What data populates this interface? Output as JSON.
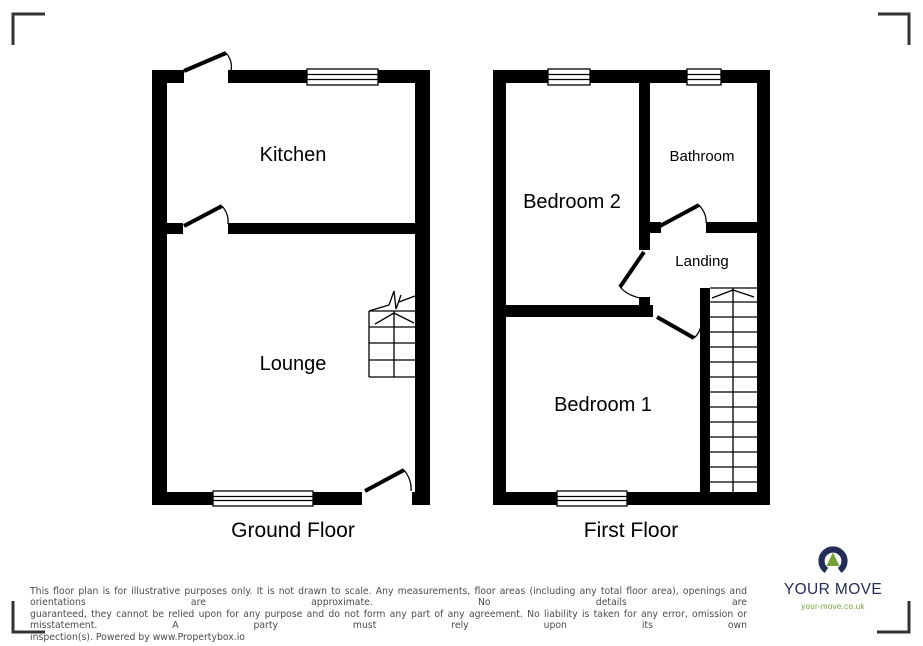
{
  "floor_plan": {
    "ground_floor": {
      "title": "Ground Floor",
      "rooms": {
        "kitchen": "Kitchen",
        "lounge": "Lounge"
      }
    },
    "first_floor": {
      "title": "First Floor",
      "rooms": {
        "bedroom2": "Bedroom 2",
        "bathroom": "Bathroom",
        "landing": "Landing",
        "bedroom1": "Bedroom 1"
      }
    }
  },
  "disclaimer_lines": [
    "This floor plan is for illustrative purposes only. It is not drawn to scale. Any measurements, floor areas (including any total floor area), openings and orientations are approximate. No details are",
    "guaranteed, they cannot be relied upon for any purpose and do not form any part of any agreement. No liability is taken for any error, omission or misstatement. A party must rely upon its own",
    "inspection(s). Powered by www.Propertybox.io"
  ],
  "logo": {
    "brand": "YOUR MOVE",
    "url": "your-move.co.uk"
  },
  "colors": {
    "wall": "#000000",
    "brand_navy": "#232e58",
    "brand_green": "#73a136",
    "disclaimer_text": "#4c4c4c"
  }
}
